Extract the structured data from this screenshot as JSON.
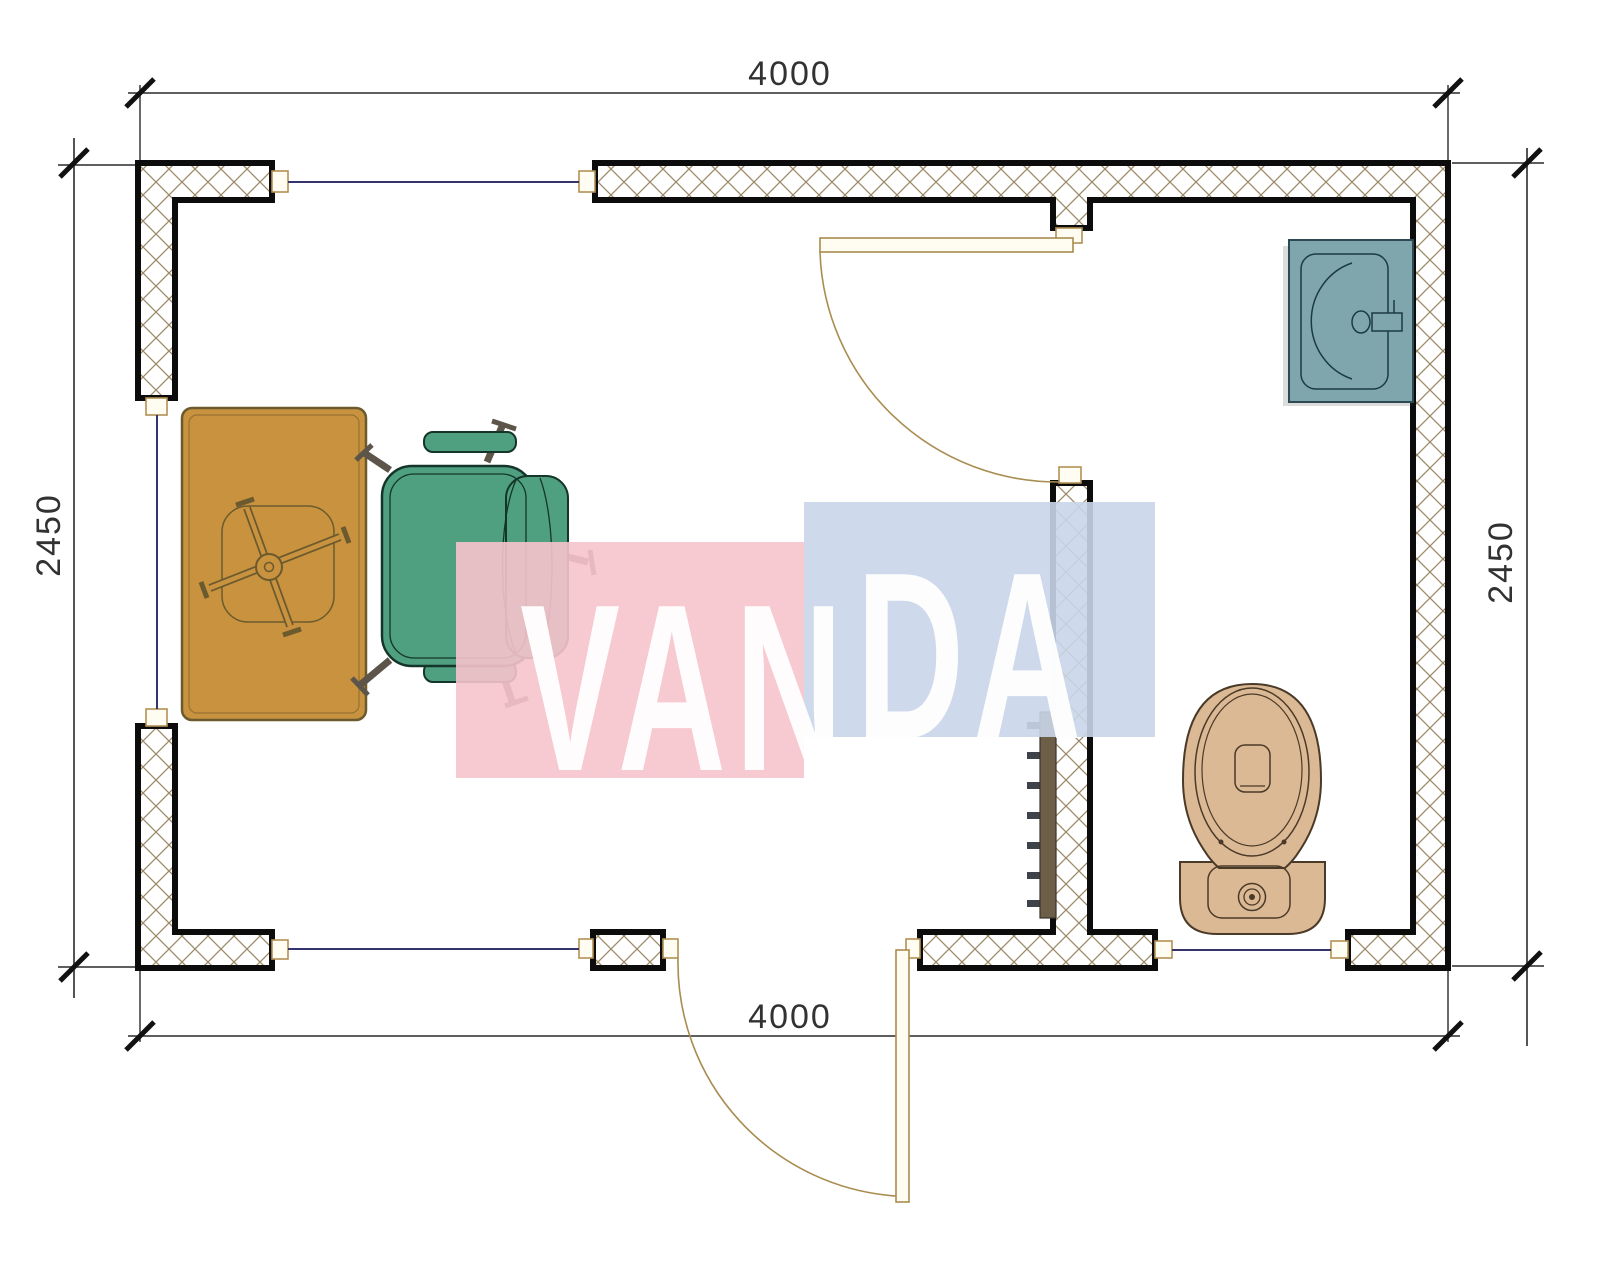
{
  "drawing": {
    "type": "floor-plan",
    "dimensions": {
      "top_width": "4000",
      "bottom_width": "4000",
      "left_height": "2450",
      "right_height": "2450"
    },
    "watermark": {
      "text": "VANDA",
      "part1": "VAN",
      "part2": "DA"
    },
    "colors": {
      "wall_hatch": "#9c8a68",
      "wall_outline": "#0c0c0c",
      "window_line": "#34346c",
      "door_line": "#a98c4f",
      "dimension_line": "#2a2a2a",
      "text": "#323232",
      "desk": "#c8923e",
      "desk_outline": "#6b5a2e",
      "chair": "#4fa081",
      "chair_outline": "#15352a",
      "toilet": "#dcb995",
      "toilet_outline": "#4a3a28",
      "sink": "#7fa6ad",
      "sink_outline": "#27454e",
      "radiator_body": "#6d5e48",
      "radiator_fins": "#3e4249",
      "watermark_pink": "#f6c3cb",
      "watermark_blue": "#c9d6e9",
      "watermark_text": "#ffffff"
    }
  }
}
